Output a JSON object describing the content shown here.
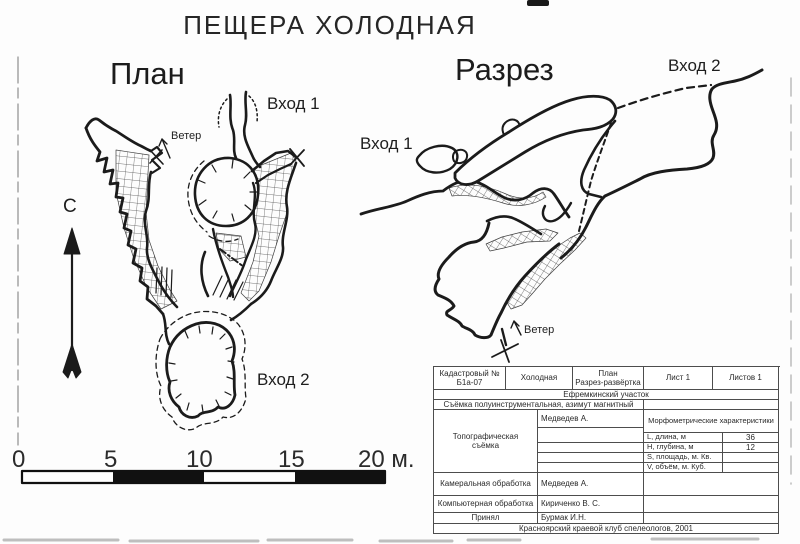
{
  "title": "ПЕЩЕРА ХОЛОДНАЯ",
  "colors": {
    "ink": "#1b1b1b",
    "paper": "#fdfdfd",
    "table_border": "#4d4d4d"
  },
  "plan": {
    "heading": "План",
    "entrance1": "Вход 1",
    "entrance2": "Вход 2",
    "wind": "Ветер",
    "north": "С"
  },
  "section": {
    "heading": "Разрез",
    "entrance1": "Вход 1",
    "entrance2": "Вход 2",
    "wind": "Ветер"
  },
  "scale_bar": {
    "ticks": [
      "0",
      "5",
      "10",
      "15",
      "20 м."
    ],
    "length_m": 20,
    "segments": 4
  },
  "table": {
    "cadastral_label": "Кадастровый №",
    "cadastral_value": "Б1а-07",
    "cave_name": "Холодная",
    "drawing_type_line1": "План",
    "drawing_type_line2": "Разрез-развёртка",
    "sheet": "Лист 1",
    "sheets": "Листов 1",
    "area": "Ефремкинский участок",
    "survey_note": "Съёмка полуинструментальная, азимут магнитный",
    "topo_label_line1": "Топографическая",
    "topo_label_line2": "съёмка",
    "topo_surveyor": "Медведев А.",
    "morpho_header": "Морфометрические характеристики",
    "morpho_rows": [
      {
        "label": "L, длина, м",
        "value": "36"
      },
      {
        "label": "Н, глубина, м",
        "value": "12"
      },
      {
        "label": "S, площадь, м. Кв.",
        "value": ""
      },
      {
        "label": "V, объём, м. Куб.",
        "value": ""
      }
    ],
    "office_label": "Камеральная обработка",
    "office_value": "Медведев А.",
    "computer_label": "Компьютерная обработка",
    "computer_value": "Кириченко В. С.",
    "accepted_label": "Принял",
    "accepted_value": "Бурмак И.Н.",
    "footer": "Красноярский краевой клуб спелеологов, 2001"
  }
}
